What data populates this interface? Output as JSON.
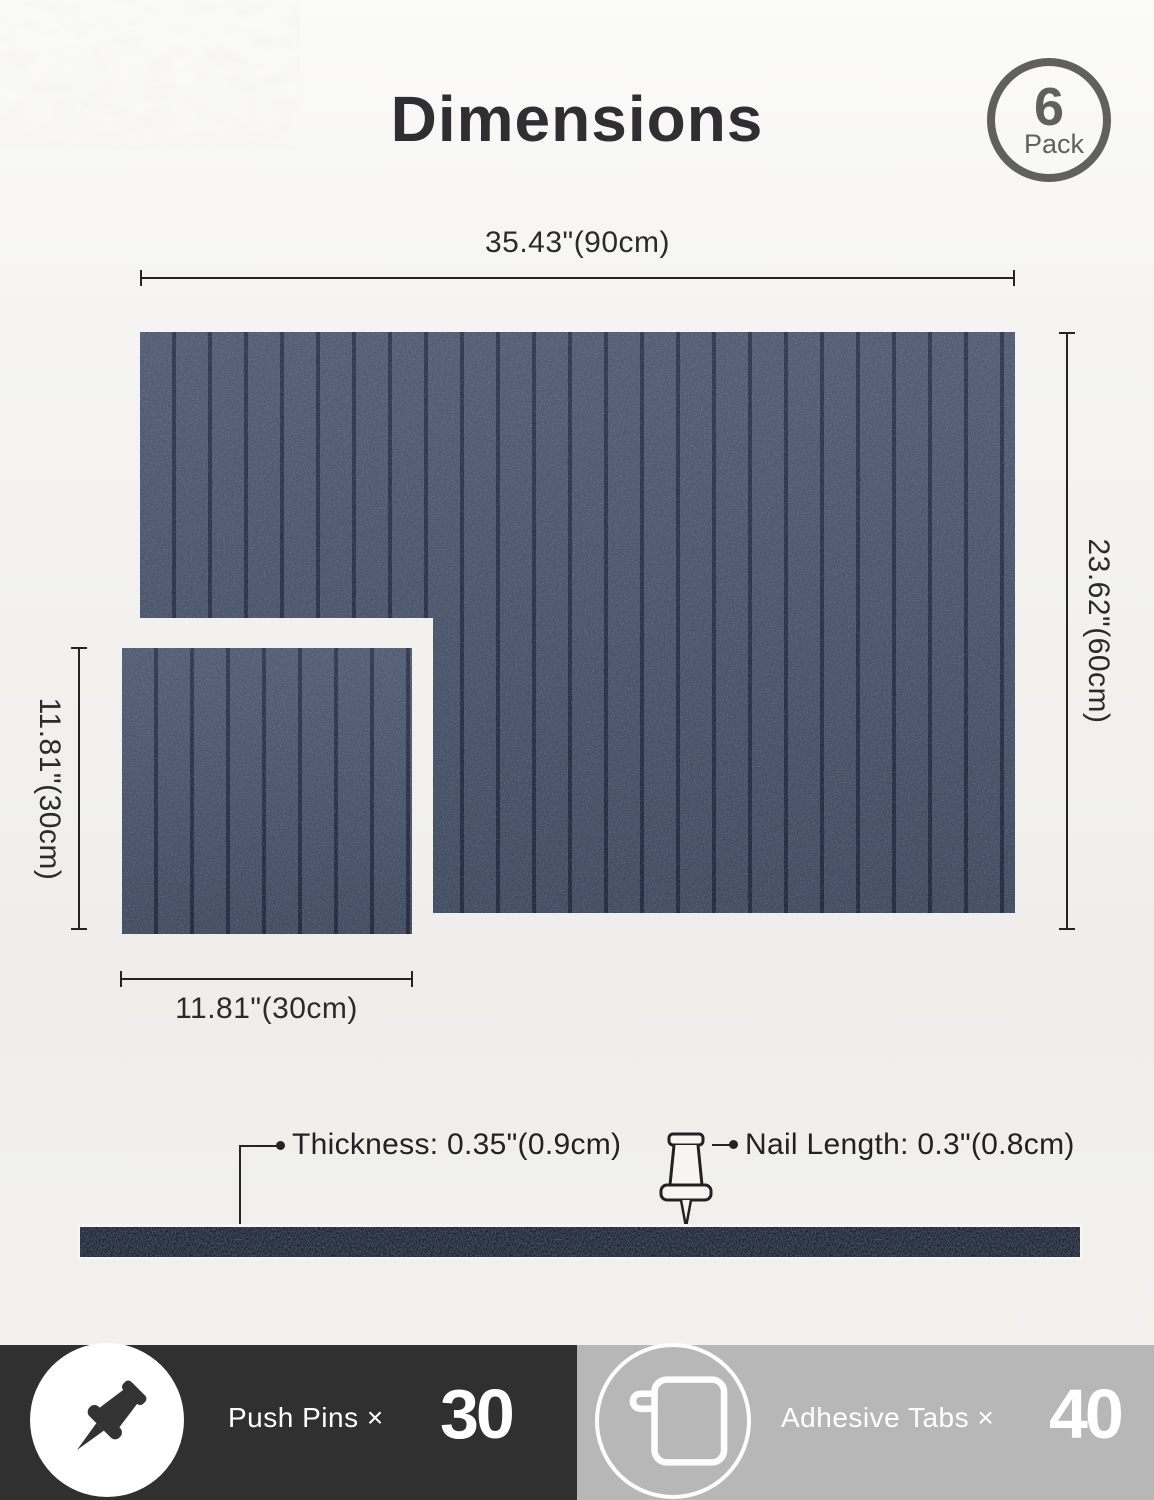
{
  "header": {
    "title": "Dimensions",
    "badge": {
      "count": "6",
      "label": "Pack"
    }
  },
  "dimensions": {
    "large_panel_width": "35.43\"(90cm)",
    "large_panel_height": "23.62\"(60cm)",
    "small_panel_height": "11.81\"(30cm)",
    "small_panel_width": "11.81\"(30cm)",
    "thickness": "Thickness: 0.35\"(0.9cm)",
    "nail_length": "Nail Length: 0.3\"(0.8cm)"
  },
  "footer": {
    "push_pins": {
      "label": "Push Pins ×",
      "count": "30"
    },
    "adhesive_tabs": {
      "label": "Adhesive Tabs ×",
      "count": "40"
    }
  },
  "colors": {
    "felt": "#49546c",
    "felt-groove": "#242e46",
    "felt-dark": "#1d2636",
    "paper": "#f1f0ed",
    "ink": "#242424",
    "badge": "#606060",
    "footer-left-bg": "#303030",
    "footer-right-bg": "#b7b7b7"
  }
}
